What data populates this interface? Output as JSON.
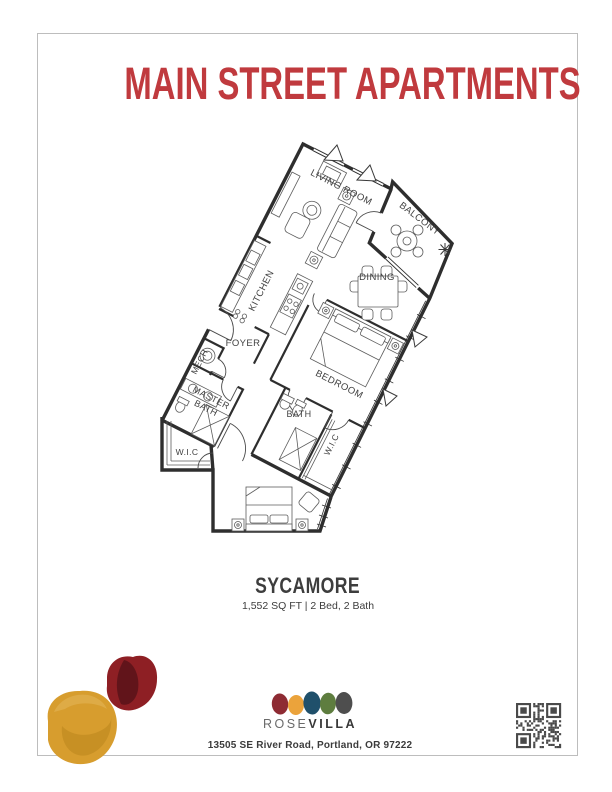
{
  "document": {
    "title": "MAIN STREET APARTMENTS",
    "unit": {
      "name": "SYCAMORE",
      "specs": "1,552 SQ FT | 2 Bed, 2 Bath"
    },
    "footer": {
      "brand_light": "ROSE",
      "brand_bold": "VILLA",
      "address": "13505 SE River Road, Portland, OR 97222"
    },
    "colors": {
      "title_red": "#C03A3E",
      "ink": "#3d3d3d",
      "wall": "#2e2e2e",
      "logo_red": "#8E2B33",
      "logo_gold": "#EBA33B",
      "logo_navy": "#20506B",
      "logo_green": "#5E7D3F",
      "logo_gray": "#4E4E4E",
      "blob_gold": "#D79D2E",
      "blob_maroon": "#8E1F24"
    }
  },
  "floor_plan": {
    "rooms": {
      "living": "LIVING ROOM",
      "balcony": "BALCONY",
      "dining": "DINING",
      "kitchen": "KITCHEN",
      "foyer": "FOYER",
      "mech": "MECH",
      "master_bath_line1": "MASTER",
      "master_bath_line2": "BATH",
      "bath": "BATH",
      "bedroom": "BEDROOM",
      "wic_master": "W.I.C",
      "wic_bedroom": "W.I.C"
    }
  }
}
